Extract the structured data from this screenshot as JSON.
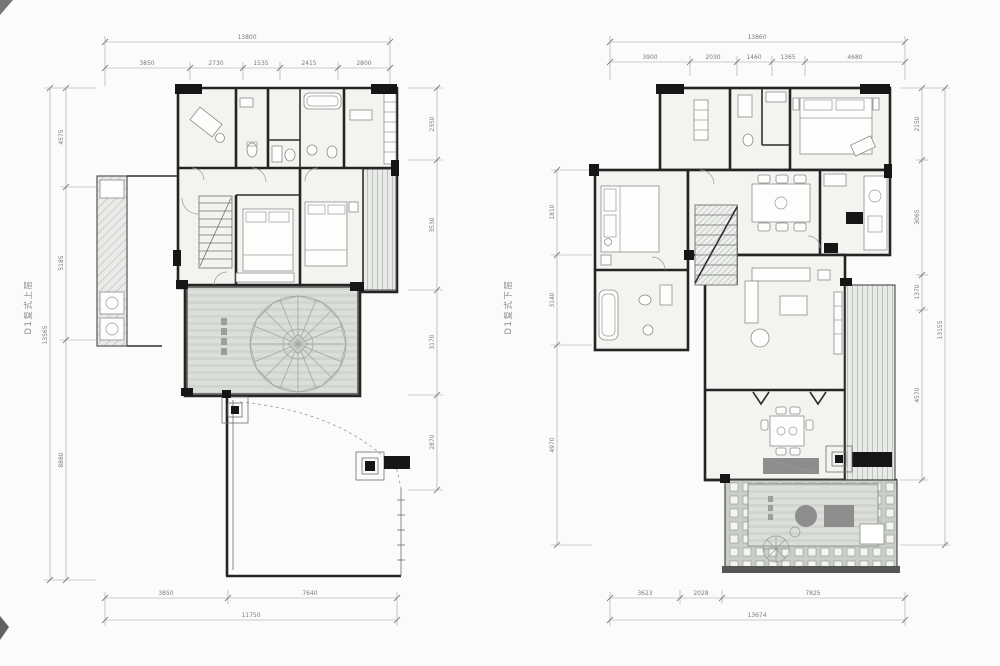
{
  "colors": {
    "background": "#fbfbfa",
    "wall": "#242424",
    "dimension_line": "#9f9f9f",
    "deck_fill": "#dbded9",
    "hatch_fill": "#e9ebe8"
  },
  "plans": {
    "left": {
      "label": "D1复式上层",
      "dims": {
        "top_total": "13800",
        "top_segments": [
          "3850",
          "2730",
          "1535",
          "2415",
          "2800"
        ],
        "bottom_segments": [
          "3850",
          "7640"
        ],
        "bottom_total": "11750",
        "left_segments": [
          "4575",
          "5185",
          "8880"
        ],
        "left_total": "13565",
        "right_segments": [
          "2350",
          "3530",
          "3170",
          "2870"
        ]
      }
    },
    "right": {
      "label": "D1复式下层",
      "dims": {
        "top_total": "13860",
        "top_segments": [
          "3900",
          "2030",
          "1460",
          "1365",
          "4680"
        ],
        "bottom_segments": [
          "3623",
          "2028",
          "7825"
        ],
        "bottom_total": "13674",
        "left_segments": [
          "1810",
          "3140",
          "4970"
        ],
        "right_segments": [
          "2150",
          "3065",
          "1370",
          "4570"
        ],
        "right_total": "13155"
      }
    }
  }
}
